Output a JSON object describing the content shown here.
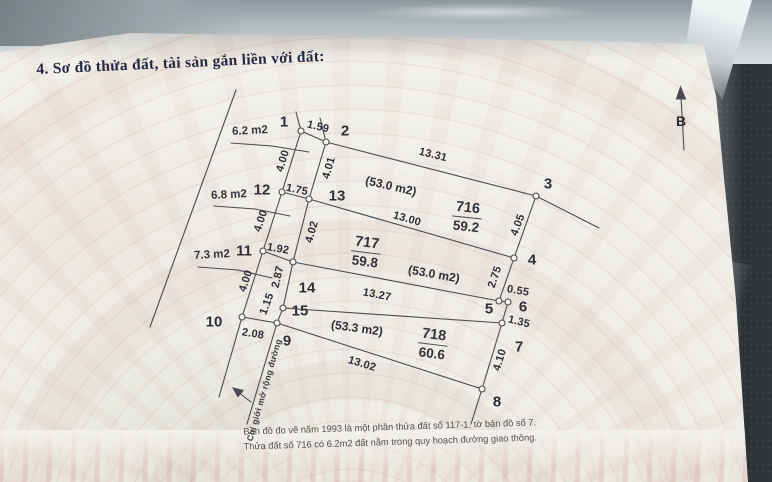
{
  "title": "4. Sơ đồ thửa đất, tài sản gắn liền với đất:",
  "north_label": "B",
  "colors": {
    "title_ink": "#252a40",
    "diagram_ink": "#4a4a50",
    "note_ink": "#57504a",
    "watermark_pink": "#c48c80"
  },
  "diagram": {
    "vertices": [
      "1",
      "2",
      "3",
      "4",
      "5",
      "6",
      "7",
      "8",
      "9",
      "10",
      "11",
      "12",
      "13",
      "14",
      "15"
    ],
    "measurements": {
      "v1_v2": "1.59",
      "v2_v3": "13.31",
      "v1_v12": "4.00",
      "v2_v13": "4.01",
      "v12_v13": "1.75",
      "v13_v4": "13.00",
      "v12_v11": "4.00",
      "v13_v14": "4.02",
      "v11_v14": "1.92",
      "v3_v4": "4.05",
      "v14_v5": "13.27",
      "v14_v15": "2.87",
      "v11_v10": "4.00",
      "v4_v5": "2.75",
      "v15_v9": "1.15",
      "v5_v6": "0.55",
      "v6_v7": "1.35",
      "v10_v9": "2.08",
      "v9_v8": "13.02",
      "v7_v8": "4.10"
    },
    "strip_areas": [
      "6.2 m2",
      "6.8 m2",
      "7.3 m2"
    ],
    "plots": [
      {
        "number": "716",
        "area": "59.2",
        "planning_area": "(53.0 m2)"
      },
      {
        "number": "717",
        "area": "59.8",
        "planning_area": "(53.0 m2)"
      },
      {
        "number": "718",
        "area": "60.6",
        "planning_area": "(53.3 m2)"
      }
    ],
    "road_boundary_label": "Chỉ giới mở rộng đường"
  },
  "notes": [
    "Bản đồ đo vẽ năm 1993 là một phần thửa đất số 117-1, tờ bản đồ số 7.",
    "Thửa đất số 716 có 6.2m2 đất nằm trong quy hoạch đường giao thông."
  ]
}
